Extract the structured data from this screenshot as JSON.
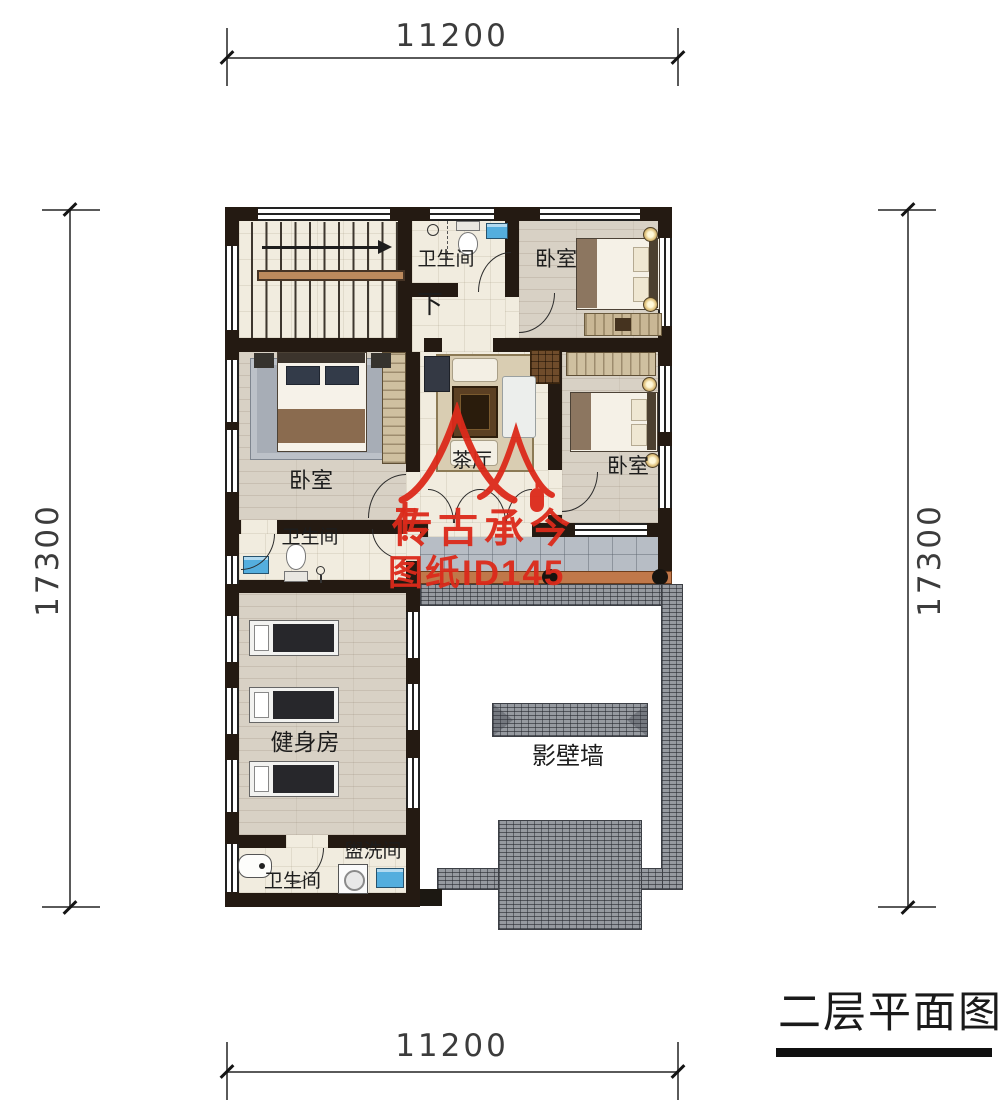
{
  "dims": {
    "top": "11200",
    "bottom": "11200",
    "left": "17300",
    "right": "17300"
  },
  "plan_title": "二层平面图",
  "rooms": {
    "bath_top": "卫生间",
    "down": "下",
    "bedroom_a": "卧室",
    "bedroom_b": "卧室",
    "tea_hall": "茶厅",
    "bedroom_c": "卧室",
    "bath_mid": "卫生间",
    "gym": "健身房",
    "laundry": "盥洗间",
    "bath_bottom": "卫生间",
    "screen_wall": "影壁墙"
  },
  "watermark": {
    "brand": "传古承今",
    "sheet_id": "图纸ID145",
    "color": "#dc2a1b"
  },
  "colors": {
    "wall": "#241a12",
    "tile_floor": "#f1ecdf",
    "wood_floor": "#d8d1c5",
    "balcony_floor": "#b7bdc5",
    "roof_tile": "#969aa0",
    "railing": "#c0784a",
    "fixture_blue": "#54aede",
    "watermark_red": "#dc2a1b"
  }
}
